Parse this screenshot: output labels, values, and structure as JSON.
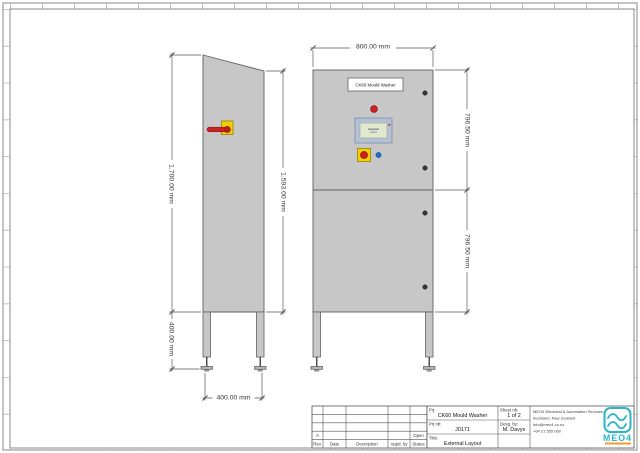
{
  "sheet": {
    "views": {
      "side": {
        "dim_front_height": "1,700.00 mm",
        "dim_body_height": "1,593.00 mm",
        "dim_leg_height": "400.00 mm",
        "dim_depth": "400.00 mm"
      },
      "front": {
        "nameplate": "CK60 Mould Washer",
        "dim_width": "800.00 mm",
        "dim_upper_door_height": "796.50 mm",
        "dim_lower_door_height": "796.50 mm"
      }
    },
    "revision_table": {
      "headers": [
        "Rev.",
        "Date",
        "Description",
        "Appd. by",
        "Status"
      ],
      "current": {
        "rev": "A",
        "status": "Open"
      }
    },
    "title_block": {
      "prj_label": "Prj:",
      "prj_value": "CK60 Mould Washer",
      "prj_nb_label": "Prj nb:",
      "prj_nb_value": "J0171",
      "title_label": "Title:",
      "title_value": "External Layout",
      "sheet_label": "Sheet nb:",
      "sheet_value": "1 of 2",
      "desg_label": "Desg. by:",
      "desg_value": "M. Davys",
      "company_name": "MEO4 Electrical & Automation Services",
      "company_location": "Auckland, New Zealand",
      "company_email": "info@meo4.co.nz",
      "company_phone": "+64 21 555 060",
      "logo_text": "MEO4"
    },
    "colors": {
      "cabinet_fill": "#c7c7c7",
      "outline": "#606060",
      "dim_line": "#555555",
      "logo_teal": "#2ab5c6",
      "logo_orange": "#f29a2e",
      "estop_yellow": "#f2cf00",
      "alert_red": "#d42020",
      "button_blue": "#1f6fd0"
    }
  }
}
